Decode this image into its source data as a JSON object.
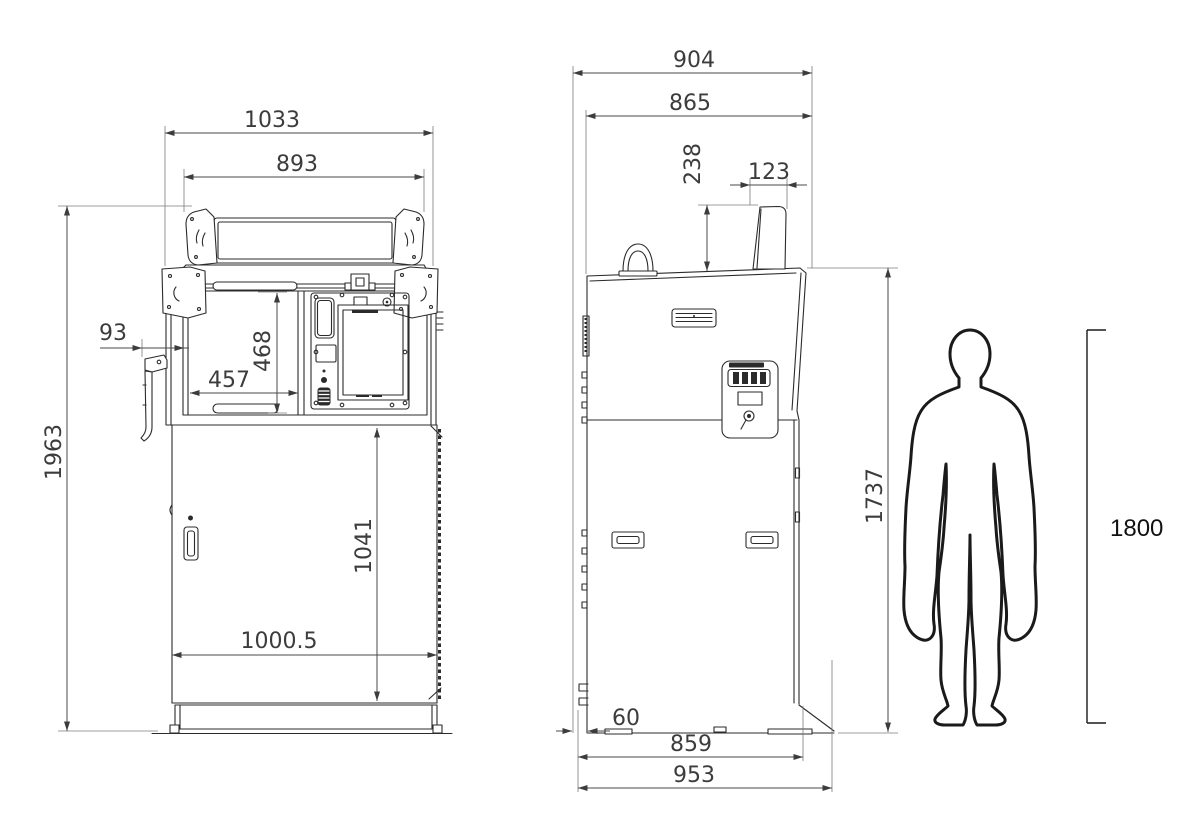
{
  "front_view": {
    "overall_width": "1033",
    "header_width": "893",
    "overall_height": "1963",
    "side_hook_offset": "93",
    "console_opening_width": "457",
    "console_opening_height": "468",
    "door_height": "1041",
    "door_width": "1000.5"
  },
  "side_view": {
    "overall_depth": "904",
    "upper_body_depth": "865",
    "rear_post_height": "238",
    "rear_post_depth": "123",
    "body_height": "1737",
    "rear_base_inset": "60",
    "base_depth": "859",
    "overall_base_depth": "953"
  },
  "human_figure": {
    "height": "1800"
  }
}
